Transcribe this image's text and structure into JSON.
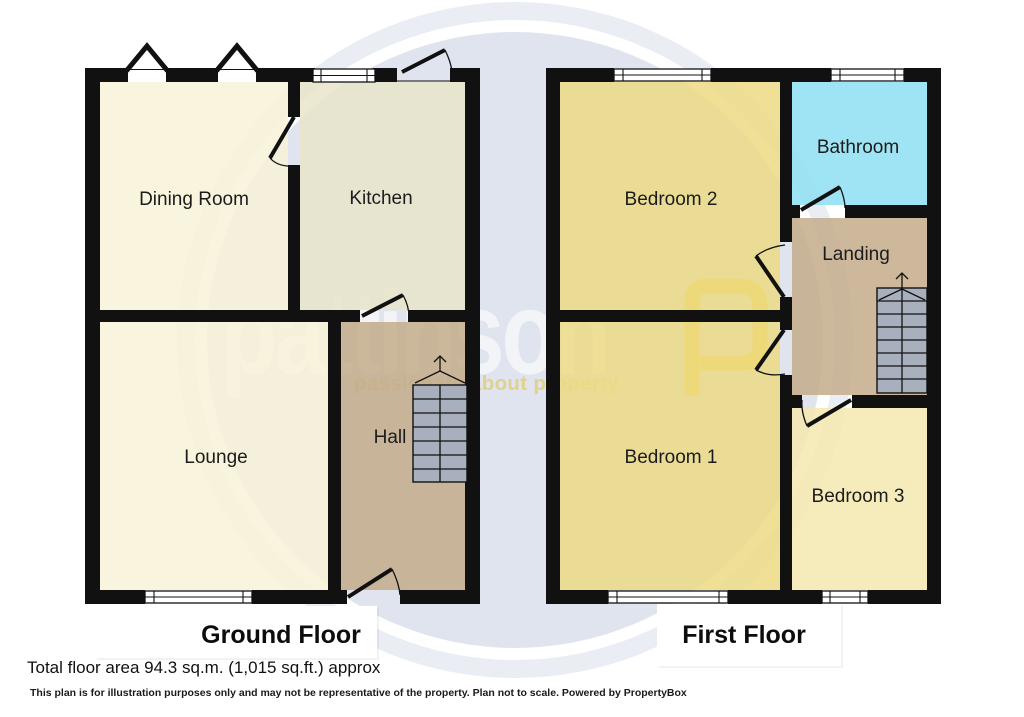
{
  "watermark": {
    "brand": "pattinson",
    "tagline": "passionate about property",
    "logo_letter": "P"
  },
  "floors": {
    "ground": {
      "title": "Ground Floor",
      "rooms": {
        "dining": "Dining Room",
        "kitchen": "Kitchen",
        "lounge": "Lounge",
        "hall": "Hall"
      }
    },
    "first": {
      "title": "First Floor",
      "rooms": {
        "bedroom2": "Bedroom 2",
        "bathroom": "Bathroom",
        "landing": "Landing",
        "bedroom1": "Bedroom 1",
        "bedroom3": "Bedroom 3"
      }
    }
  },
  "footer": {
    "total_area": "Total floor area 94.3 sq.m. (1,015 sq.ft.) approx",
    "disclaimer": "This plan is for illustration purposes only and may not be representative of the property. Plan not to scale. Powered by PropertyBox"
  },
  "colors": {
    "wall": "#111111",
    "room_cream": "#f8f2d7",
    "room_kitchen": "#e9e4c9",
    "room_tan": "#c4ac8a",
    "room_bedroom": "#ecda84",
    "room_bedroom3": "#f4e8ae",
    "room_bathroom": "#8edff2",
    "stairs": "#a8b0be",
    "watermark_disc": "#dfe4ee",
    "watermark_halo": "#eaedf4",
    "watermark_yellow": "#eec32f"
  }
}
